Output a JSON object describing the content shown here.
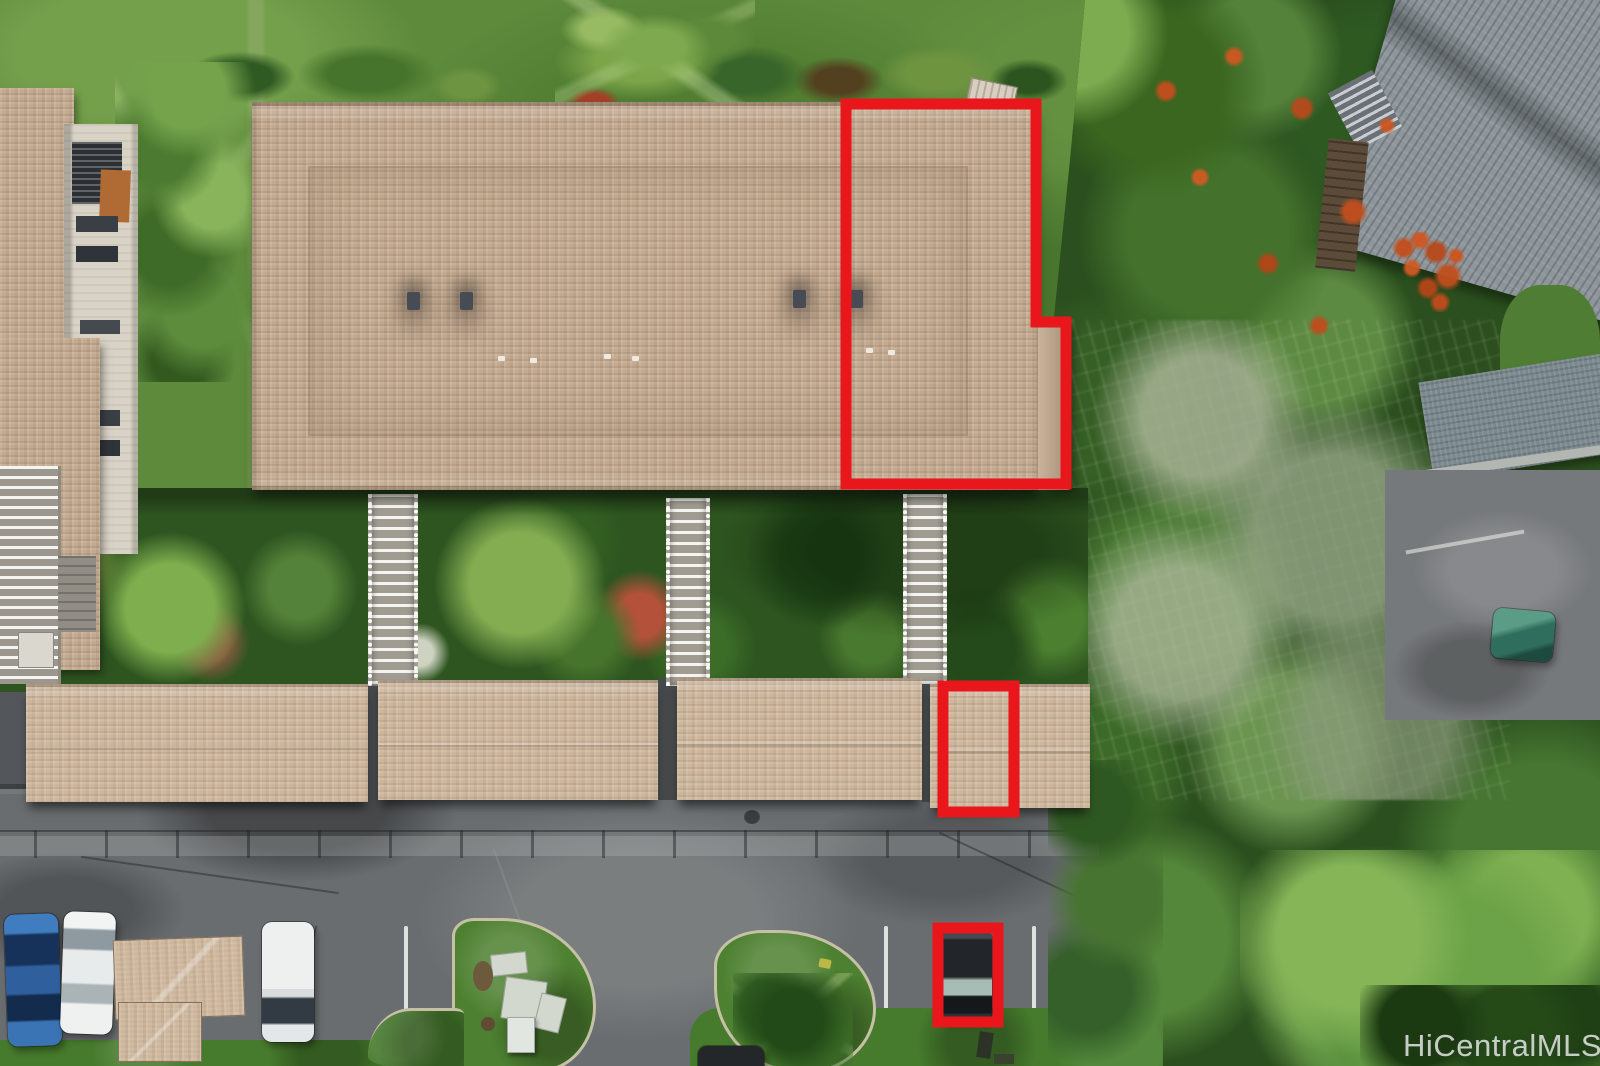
{
  "watermark": {
    "text": "HiCentralMLS"
  },
  "annotations": {
    "unit_outline_points": "846,104 1036,104 1036,322 1066,322 1066,484 846,484",
    "storage_outline_path": "M943 686 H1014 V812 H943 Z",
    "parking_outline_path": "M938 928 H998 V1022 H938 Z",
    "stroke_width": "11"
  },
  "colors": {
    "highlight": "#e9161b",
    "roof_tan": "#c3a98f",
    "roof_tan_light": "#cdb69c",
    "roof_gray": "#8d969b",
    "grass": "#5e8a3c",
    "grass_dark": "#2e5520",
    "asphalt": "#696d6f",
    "asphalt_dark": "#53565a",
    "foliage_dark": "#2b4f1e",
    "foliage_light": "#7cab50",
    "flower_orange": "#c8511f",
    "walkway": "#b5b1a7",
    "curb": "#c6c1a6",
    "car_blue": "#2f5f9d",
    "car_white": "#eef0f0",
    "car_dark": "#23272b",
    "car_teal": "#3a8671",
    "watermark": "#e3e7e1"
  }
}
